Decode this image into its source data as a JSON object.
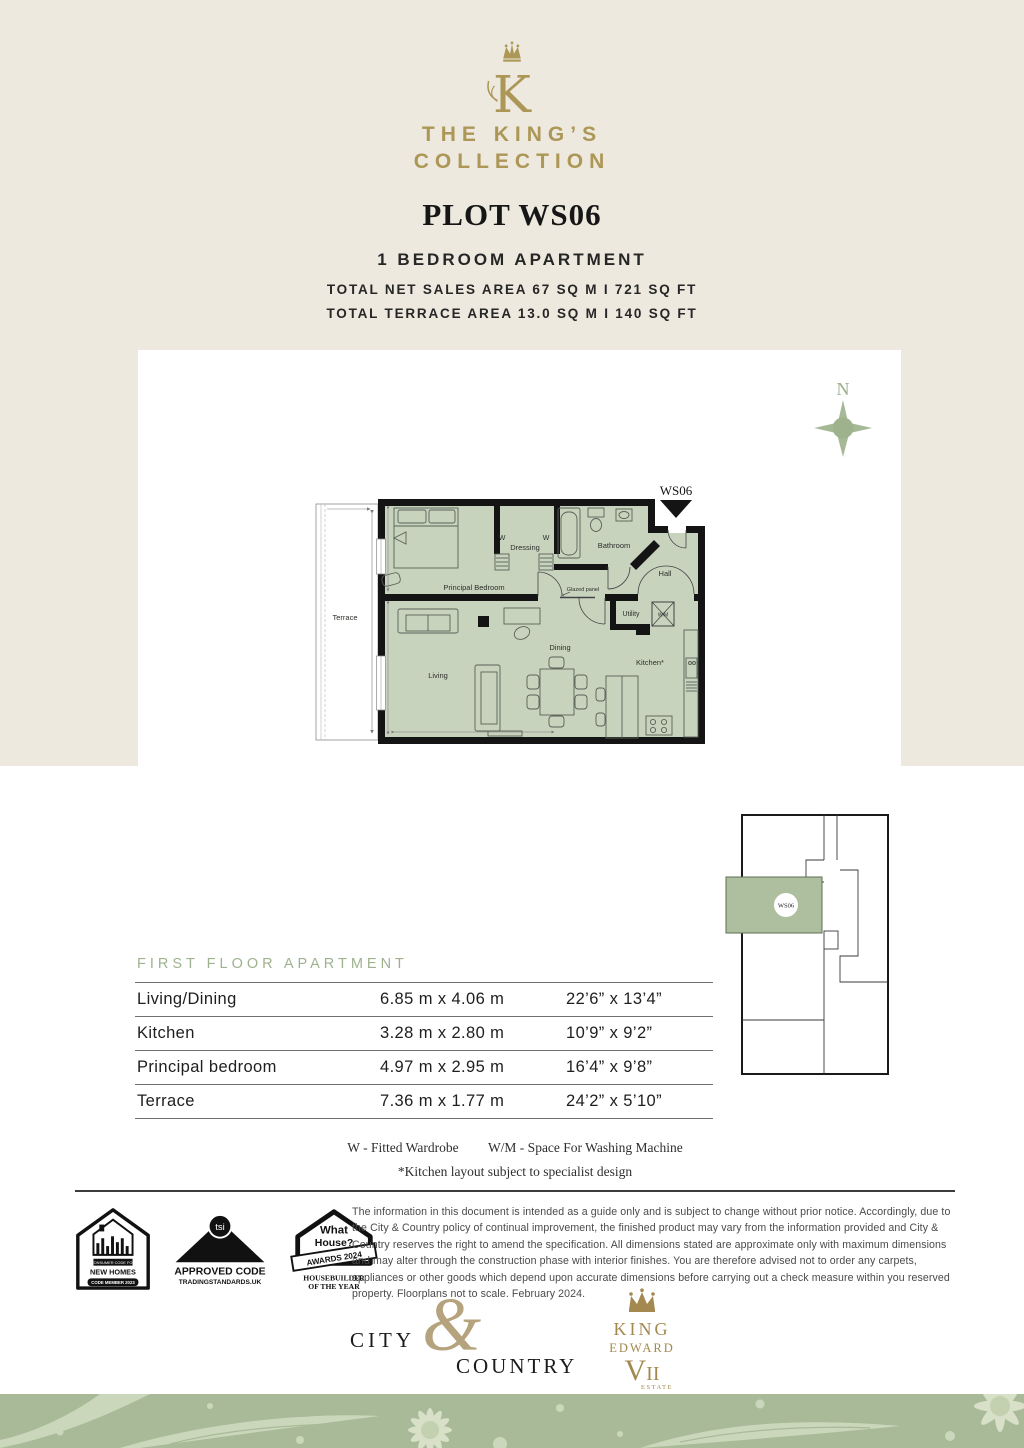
{
  "brand": {
    "monogram": "K",
    "name_line1": "THE KING’S",
    "name_line2": "COLLECTION",
    "gold": "#AC9756"
  },
  "header": {
    "plot_title": "PLOT WS06",
    "subtitle": "1 BEDROOM APARTMENT",
    "area_line1": "TOTAL NET SALES AREA 67 SQ M  I  721 SQ FT",
    "area_line2": "TOTAL TERRACE AREA 13.0 SQ M  I  140 SQ FT"
  },
  "compass": {
    "label": "N",
    "color": "#A5B894"
  },
  "floorplan": {
    "plot_label": "WS06",
    "room_fill": "#C8D3BE",
    "labels": {
      "terrace": "Terrace",
      "principal_bedroom": "Principal Bedroom",
      "w_left": "W",
      "w_right": "W",
      "dressing": "Dressing",
      "bathroom": "Bathroom",
      "hall": "Hall",
      "glazed_panel": "Glazed panel",
      "utility": "Utility",
      "wm": "W/M",
      "dining": "Dining",
      "kitchen": "Kitchen*",
      "living": "Living"
    }
  },
  "locator": {
    "unit_label": "WS06",
    "highlight": "#ADBF9E"
  },
  "dimensions_table": {
    "heading": "FIRST FLOOR APARTMENT",
    "rows": [
      {
        "room": "Living/Dining",
        "metric": "6.85 m x 4.06 m",
        "imperial": "22’6” x 13’4”"
      },
      {
        "room": "Kitchen",
        "metric": "3.28 m x 2.80 m",
        "imperial": "10’9” x 9’2”"
      },
      {
        "room": "Principal bedroom",
        "metric": "4.97 m x 2.95 m",
        "imperial": "16’4” x 9’8”"
      },
      {
        "room": "Terrace",
        "metric": "7.36 m x 1.77 m",
        "imperial": "24’2” x 5’10”"
      }
    ]
  },
  "legend": {
    "item1": "W - Fitted Wardrobe",
    "item2": "W/M - Space For Washing Machine",
    "note": "*Kitchen layout subject to specialist design"
  },
  "badges": {
    "new_homes": {
      "top": "CONSUMER CODE FOR",
      "name": "NEW HOMES",
      "member": "CODE MEMBER 2023"
    },
    "tsi": {
      "circle": "tsi",
      "line1": "APPROVED CODE",
      "line2": "TRADINGSTANDARDS.UK"
    },
    "what_house": {
      "line1": "What",
      "line2": "House?",
      "ribbon": "AWARDS 2024",
      "line3": "HOUSEBUILDER",
      "line4": "OF THE YEAR"
    }
  },
  "disclaimer": "The information in this document is intended as a guide only and is subject to change without prior notice. Accordingly, due to the City & Country policy of continual improvement, the finished product may vary from the information provided and City & Country reserves the right to amend the specification. All dimensions stated are approximate only with maximum dimensions and may alter through the construction phase with interior finishes. You are therefore advised not to order any carpets, appliances or other goods which depend upon accurate dimensions before carrying out a check measure within you reserved property. Floorplans not to scale. February 2024.",
  "footer_logos": {
    "city": "CITY",
    "amp": "&",
    "country": "COUNTRY",
    "ke_king": "KING",
    "ke_edward": "EDWARD",
    "ke_v": "V",
    "ke_ii": "II",
    "ke_estate": "ESTATE"
  }
}
